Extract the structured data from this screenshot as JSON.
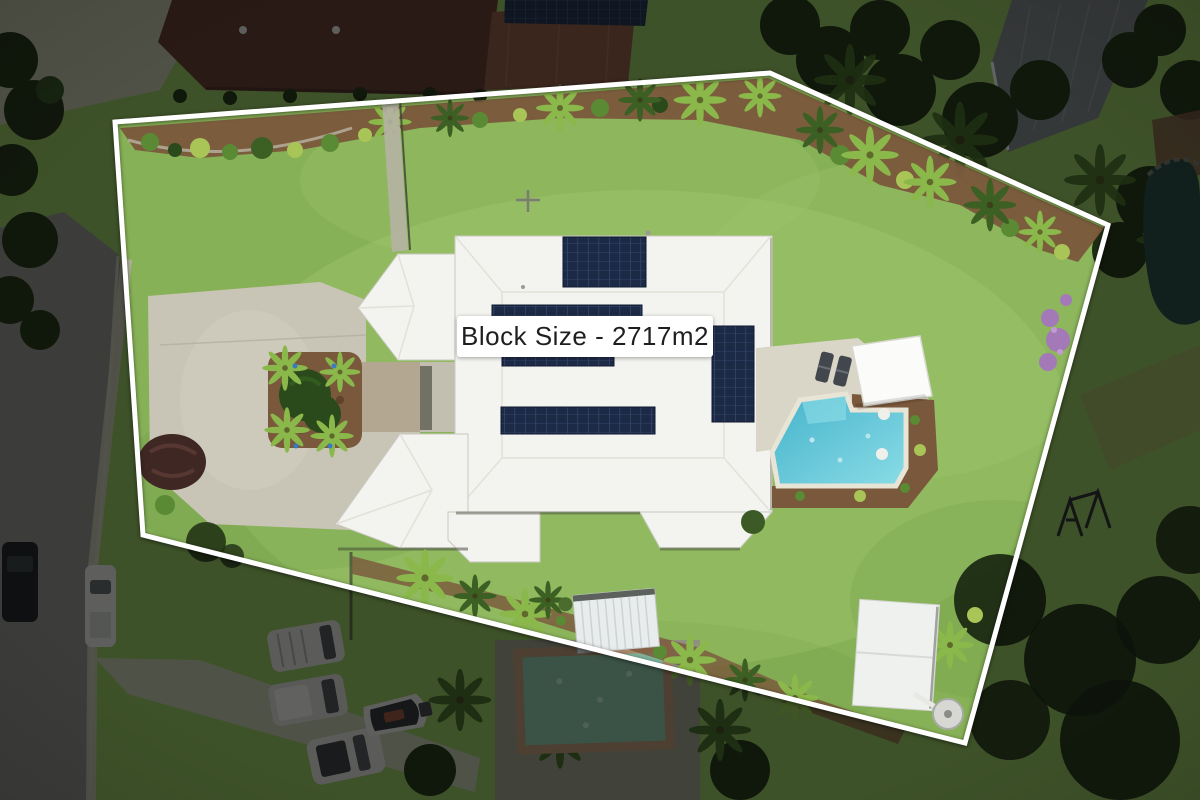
{
  "overlay": {
    "block_size_label": "Block Size - 2717m2",
    "block_size_m2": 2717,
    "label_bg": "#ffffff",
    "label_text_color": "#1f1f1f",
    "boundary_color": "#ffffff"
  },
  "scene": {
    "type": "aerial-drone-photo",
    "subject": "residential property with highlighted lot boundary",
    "features": [
      "white-roof house with five rooftop solar panel arrays",
      "swimming pool with shade canopy and two sun loungers",
      "large green lawn inside boundary",
      "concrete driveway with palm garden island and clipped hedge",
      "garden beds with palms and shrubs along boundary",
      "two garden sheds and a round water tank",
      "surrounding street, footpath, parked cars, boat on trailer, neighbouring roofs, pool, pond and trees (dimmed outside boundary)"
    ]
  },
  "palette": {
    "lawn": "#87b157",
    "lawnlight": "#9dc56c",
    "lawndark": "#5f8c3c",
    "roof": "#f3f3ef",
    "roofline": "#e2e1d9",
    "solar": "#1d2a45",
    "drive": "#c9c5b6",
    "deck": "#d9d5c7",
    "road": "#82827e",
    "walk": "#b5b2a4",
    "mulch": "#7a583c",
    "mulchdark": "#5e4229",
    "hedge": "#2b4a1b",
    "palm": "#8ab84a",
    "palmdark": "#3c6023",
    "shrub": "#5a8a34",
    "shrublight": "#a9c457",
    "treedark": "#1e2d13",
    "maroon": "#5a332b",
    "terra": "#7d4e3b",
    "grayroof": "#72777c",
    "pond": "#20403d",
    "dirt": "#72503c",
    "poolwater": "#4fbdd3",
    "poollight": "#8fdde8",
    "purple": "#a379b8",
    "boundary": "#ffffff"
  }
}
